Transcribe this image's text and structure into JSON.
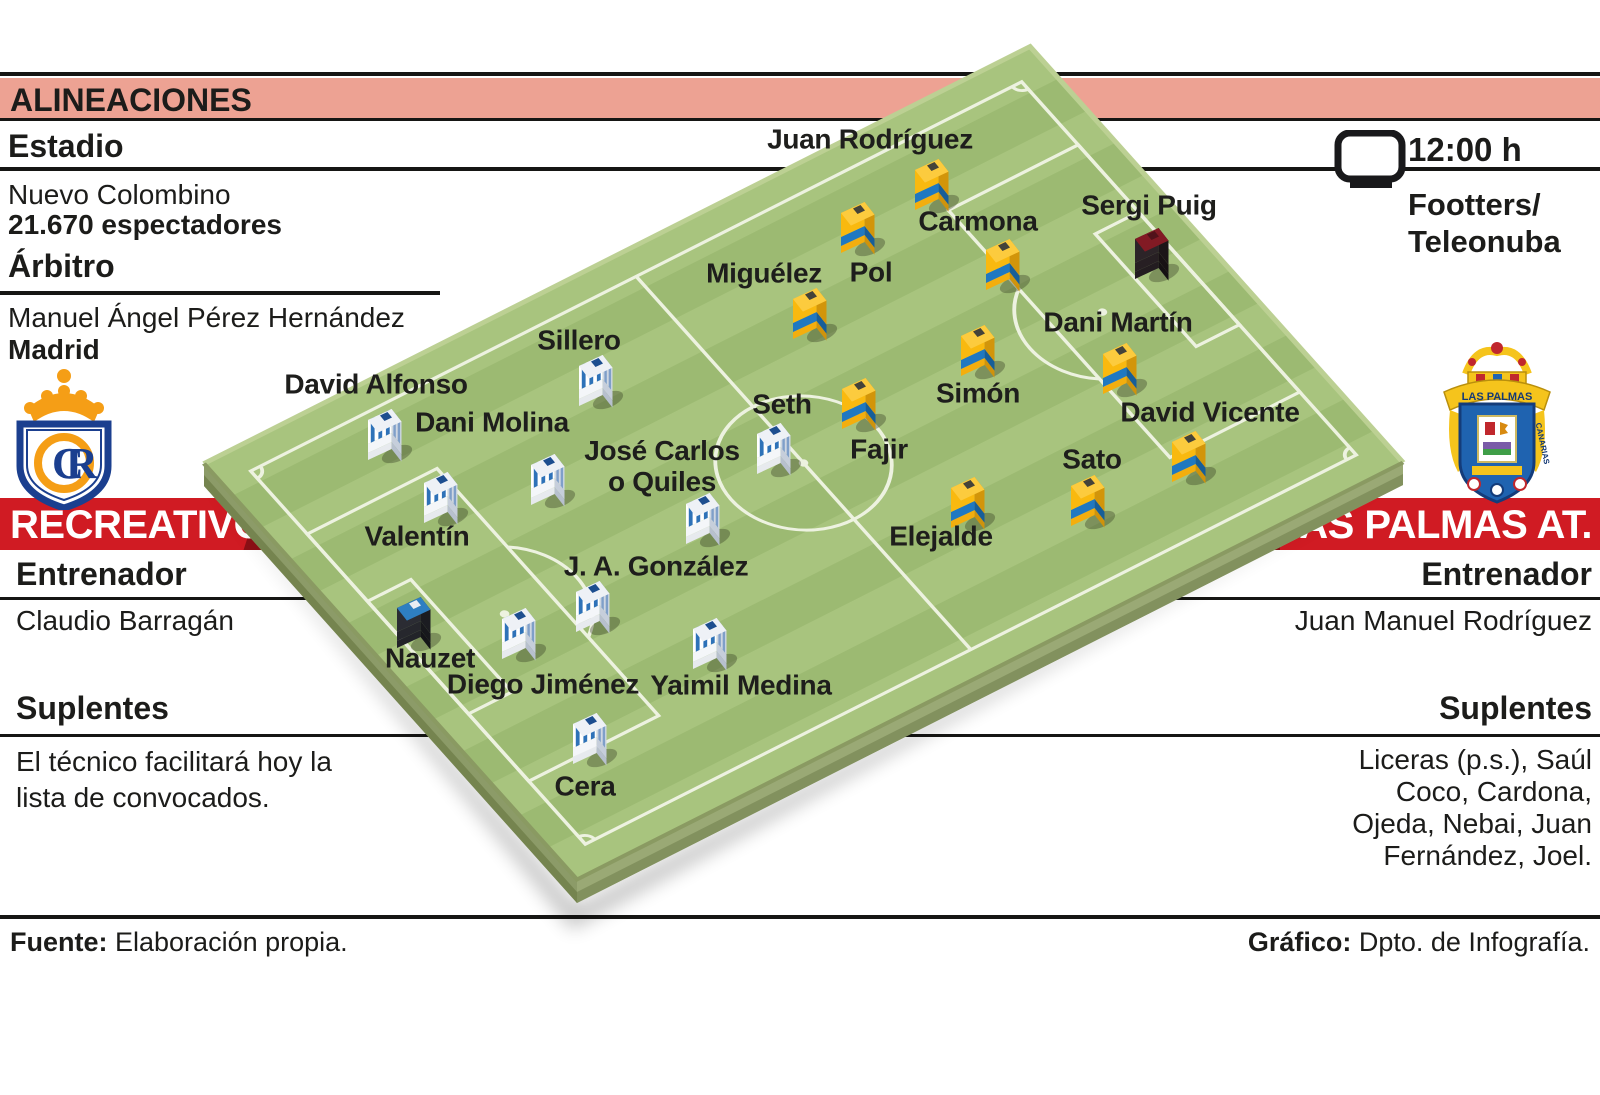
{
  "header": {
    "title": "ALINEACIONES"
  },
  "left": {
    "estadio_label": "Estadio",
    "estadio_name": "Nuevo Colombino",
    "estadio_capacity": "21.670 espectadores",
    "arbitro_label": "Árbitro",
    "arbitro_name": "Manuel Ángel Pérez Hernández",
    "arbitro_city": "Madrid",
    "team_name": "RECREATIVO",
    "entrenador_label": "Entrenador",
    "entrenador_name": "Claudio Barragán",
    "suplentes_label": "Suplentes",
    "suplentes_text": "El técnico facilitará hoy la\nlista de convocados."
  },
  "right": {
    "time": "12:00 h",
    "tv_channels": "Footters/\nTeleonuba",
    "team_name": "LAS PALMAS AT.",
    "entrenador_label": "Entrenador",
    "entrenador_name": "Juan Manuel Rodríguez",
    "suplentes_label": "Suplentes",
    "suplentes_text": "Liceras (p.s.), Saúl\nCoco, Cardona,\nOjeda, Nebai, Juan\nFernández, Joel."
  },
  "footer": {
    "fuente_label": "Fuente:",
    "fuente_text": " Elaboración propia.",
    "grafico_label": "Gráfico:",
    "grafico_text": " Dpto. de Infografía."
  },
  "crests": {
    "recreativo_monogram_c": "C",
    "recreativo_monogram_r": "R",
    "laspalmas_scroll": "LAS PALMAS",
    "laspalmas_scroll_right": "CANARIAS"
  },
  "colors": {
    "bar": "#eda293",
    "banner_red": "#d01b23",
    "banner_dark": "#8c1016",
    "pitch": {
      "light": "#a8c47e",
      "dark": "#9cba72",
      "line": "#edf2e0",
      "side_left": "#8c9b68",
      "side_right": "#9aa975",
      "side_left_low": "#75844f",
      "side_right_low": "#82915e"
    },
    "kits": {
      "recreativo": {
        "front": "#ffffff",
        "side": "#cfd7e2",
        "top": "#eef1f6",
        "collar": "#1d4e8f",
        "shorts": "#f4f6f9",
        "shortsSide": "#c6cedb",
        "base": "#e7eaee",
        "baseSide": "#b7c0ce",
        "stripe": "#2e72b8",
        "sideStripe": "#7f9fc9",
        "striped": true
      },
      "laspalmas": {
        "front": "#f9b90f",
        "side": "#d2950a",
        "top": "#fccb3e",
        "collar": "#44433a",
        "shorts": "#1f78c1",
        "shortsSide": "#175e99",
        "base": "#f3ae0e",
        "baseSide": "#cf930c",
        "striped": false
      },
      "gk_recreativo": {
        "front": "#2b2c33",
        "side": "#1b1c21",
        "top": "#2e7fc2",
        "collar": "#e9edf2",
        "shorts": "#26272d",
        "shortsSide": "#17181c",
        "base": "#222329",
        "baseSide": "#141518",
        "striped": false
      },
      "gk_laspalmas": {
        "front": "#2c2428",
        "side": "#1c1518",
        "top": "#821a24",
        "collar": "#51121a",
        "shorts": "#271f23",
        "shortsSide": "#181114",
        "base": "#231c20",
        "baseSide": "#151013",
        "striped": false
      }
    }
  },
  "players": [
    {
      "name": "Juan Rodríguez",
      "team": "laspalmas",
      "gk": false,
      "lx": 870,
      "ly": 139,
      "fx": 932,
      "fy": 186
    },
    {
      "name": "Carmona",
      "team": "laspalmas",
      "gk": false,
      "lx": 978,
      "ly": 221,
      "fx": 1003,
      "fy": 266
    },
    {
      "name": "Pol",
      "team": "laspalmas",
      "gk": false,
      "lx": 871,
      "ly": 272,
      "fx": 858,
      "fy": 229
    },
    {
      "name": "Miguélez",
      "team": "laspalmas",
      "gk": false,
      "lx": 764,
      "ly": 273,
      "fx": 810,
      "fy": 315
    },
    {
      "name": "Sergi Puig",
      "team": "laspalmas",
      "gk": true,
      "lx": 1149,
      "ly": 205,
      "fx": 1152,
      "fy": 255
    },
    {
      "name": "Dani Martín",
      "team": "laspalmas",
      "gk": false,
      "lx": 1118,
      "ly": 322,
      "fx": 1120,
      "fy": 370
    },
    {
      "name": "Simón",
      "team": "laspalmas",
      "gk": false,
      "lx": 978,
      "ly": 393,
      "fx": 978,
      "fy": 352
    },
    {
      "name": "Fajir",
      "team": "laspalmas",
      "gk": false,
      "lx": 879,
      "ly": 449,
      "fx": 859,
      "fy": 405
    },
    {
      "name": "David Vicente",
      "team": "laspalmas",
      "gk": false,
      "lx": 1210,
      "ly": 412,
      "fx": 1189,
      "fy": 458
    },
    {
      "name": "Sato",
      "team": "laspalmas",
      "gk": false,
      "lx": 1092,
      "ly": 459,
      "fx": 1088,
      "fy": 502
    },
    {
      "name": "Elejalde",
      "team": "laspalmas",
      "gk": false,
      "lx": 941,
      "ly": 536,
      "fx": 968,
      "fy": 504
    },
    {
      "name": "Sillero",
      "team": "recreativo",
      "gk": false,
      "lx": 579,
      "ly": 340,
      "fx": 596,
      "fy": 382
    },
    {
      "name": "David Alfonso",
      "team": "recreativo",
      "gk": false,
      "lx": 376,
      "ly": 384,
      "fx": 385,
      "fy": 436
    },
    {
      "name": "Dani Molina",
      "team": "recreativo",
      "gk": false,
      "lx": 492,
      "ly": 422,
      "fx": 548,
      "fy": 481
    },
    {
      "name": "Valentín",
      "team": "recreativo",
      "gk": false,
      "lx": 417,
      "ly": 536,
      "fx": 441,
      "fy": 499
    },
    {
      "name": "Seth",
      "team": "recreativo",
      "gk": false,
      "lx": 782,
      "ly": 404,
      "fx": 774,
      "fy": 450
    },
    {
      "name": "José Carlos\no Quiles",
      "team": "recreativo",
      "gk": false,
      "lx": 662,
      "ly": 466,
      "fx": 703,
      "fy": 520
    },
    {
      "name": "J. A. González",
      "team": "recreativo",
      "gk": false,
      "lx": 656,
      "ly": 566,
      "fx": 593,
      "fy": 608
    },
    {
      "name": "Nauzet",
      "team": "recreativo",
      "gk": true,
      "lx": 430,
      "ly": 658,
      "fx": 414,
      "fy": 624
    },
    {
      "name": "Diego Jiménez",
      "team": "recreativo",
      "gk": false,
      "lx": 543,
      "ly": 684,
      "fx": 519,
      "fy": 635
    },
    {
      "name": "Yaimil Medina",
      "team": "recreativo",
      "gk": false,
      "lx": 741,
      "ly": 685,
      "fx": 710,
      "fy": 645
    },
    {
      "name": "Cera",
      "team": "recreativo",
      "gk": false,
      "lx": 585,
      "ly": 786,
      "fx": 590,
      "fy": 740
    }
  ]
}
